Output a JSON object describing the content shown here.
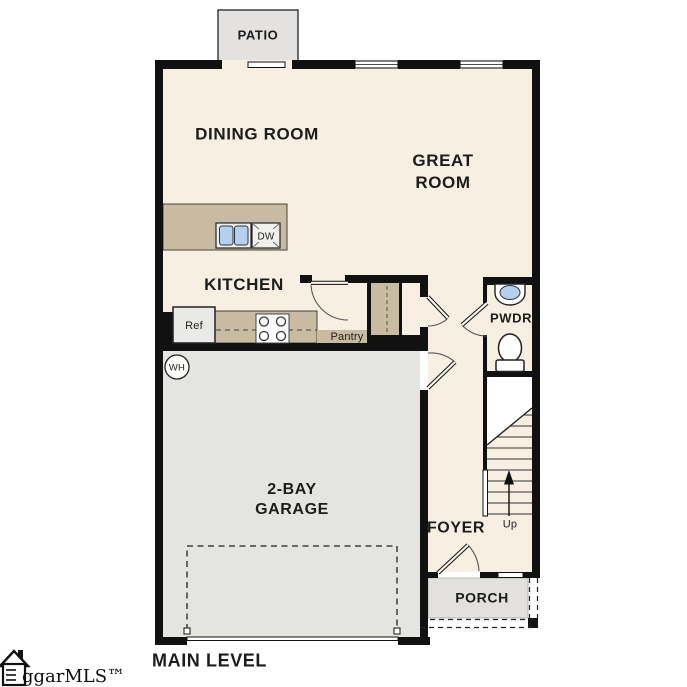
{
  "floorplan": {
    "level_label": "MAIN LEVEL",
    "logo": {
      "text": "ggarMLS™",
      "icon": "house-icon"
    },
    "rooms": {
      "patio": "PATIO",
      "dining_room": "DINING ROOM",
      "great_room_line1": "GREAT",
      "great_room_line2": "ROOM",
      "kitchen": "KITCHEN",
      "powder_room": "PWDR",
      "garage_line1": "2-BAY",
      "garage_line2": "GARAGE",
      "foyer": "FOYER",
      "porch": "PORCH"
    },
    "fixtures": {
      "refrigerator": "Ref",
      "dishwasher": "DW",
      "pantry": "Pantry",
      "water_heater": "WH"
    },
    "stairs": {
      "direction_label": "Up"
    },
    "colors": {
      "floor": "#f7efe1",
      "wall": "#111111",
      "counter_tan": "#c9bba1",
      "garage_gray": "#e4e4e1",
      "porch_gray": "#e2e1de",
      "patio_gray": "#e3e2e0",
      "sink_blue": "#b5d0ec",
      "fixture_white": "#ffffff"
    }
  }
}
